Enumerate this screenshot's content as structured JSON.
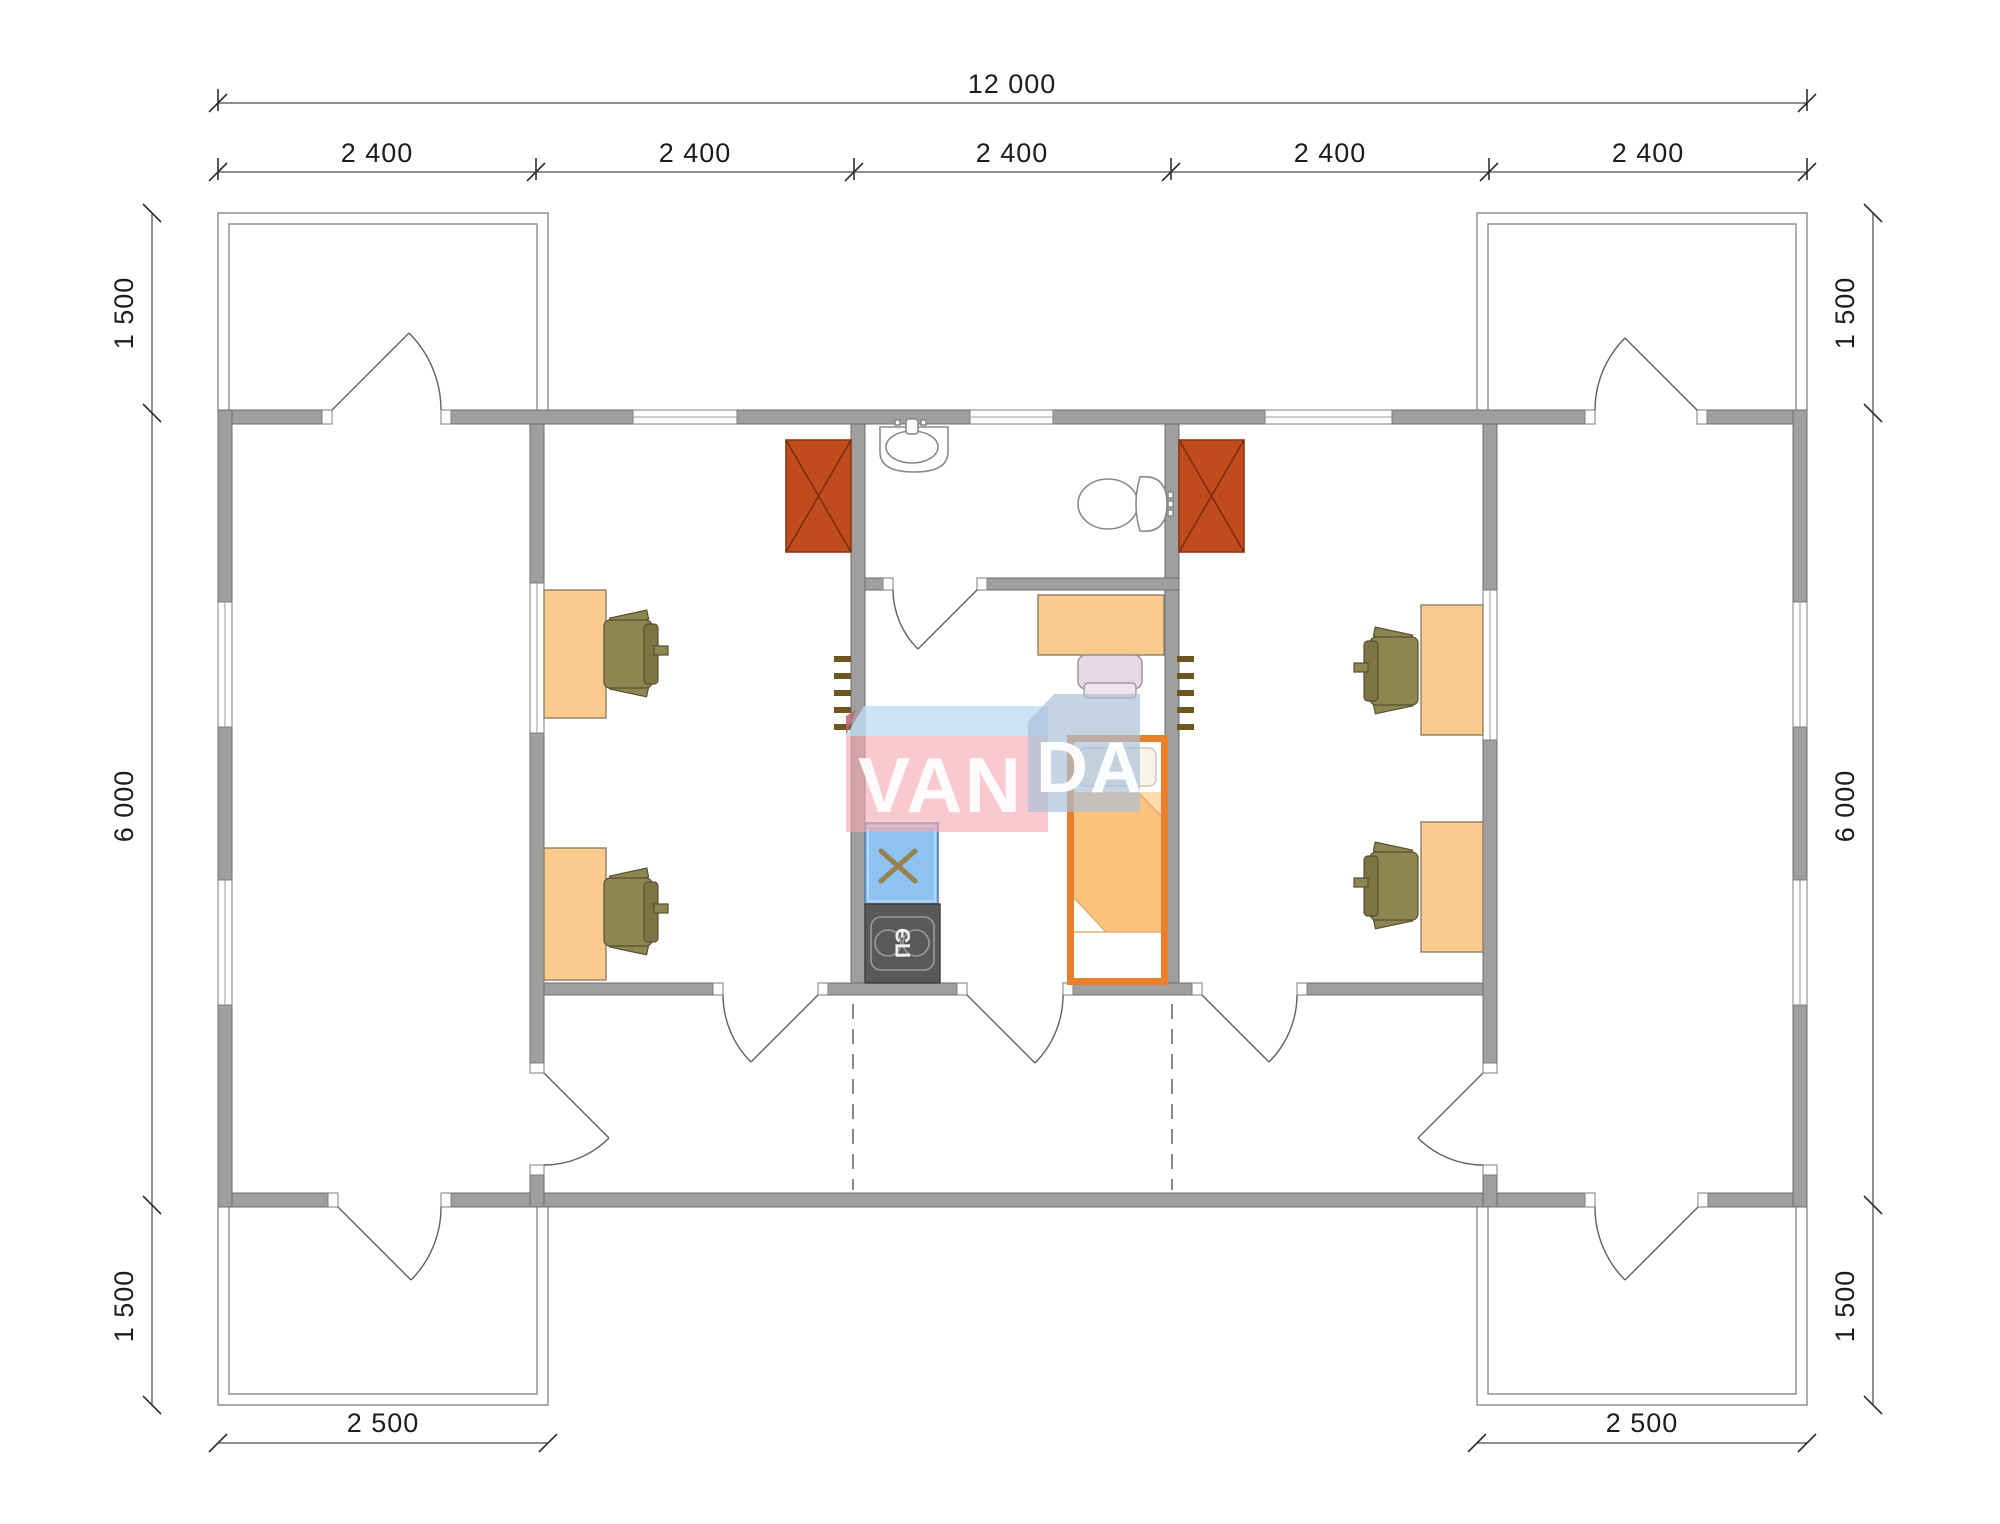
{
  "plan": {
    "type": "modular-house-floor-plan",
    "watermark": {
      "full": "VANDA",
      "part1": "VAN",
      "part2": "DA"
    },
    "dimensions": {
      "total_width": "12 000",
      "modules": [
        "2 400",
        "2 400",
        "2 400",
        "2 400",
        "2 400"
      ],
      "side_top": "1 500",
      "side_middle": "6 000",
      "side_bottom": "1 500",
      "porch_width": "2 500"
    },
    "labels": {
      "stove": "ПЭ"
    },
    "colors": {
      "wall": "#9f9f9f",
      "wall_border": "#6e6e6e",
      "wardrobe": "#c04b1d",
      "desk": "#fbca8e",
      "chair_olive": "#8e8551",
      "chair_pink": "#e7d9e1",
      "bed_frame": "#e8802e",
      "blanket": "#fcc27e",
      "sink_counter": "#8ec2f1",
      "stove": "#595959",
      "watermark_pink": "#f3a9b1",
      "watermark_blue": "#bfdcf3",
      "watermark_bluegray": "#a9bfd8"
    }
  }
}
